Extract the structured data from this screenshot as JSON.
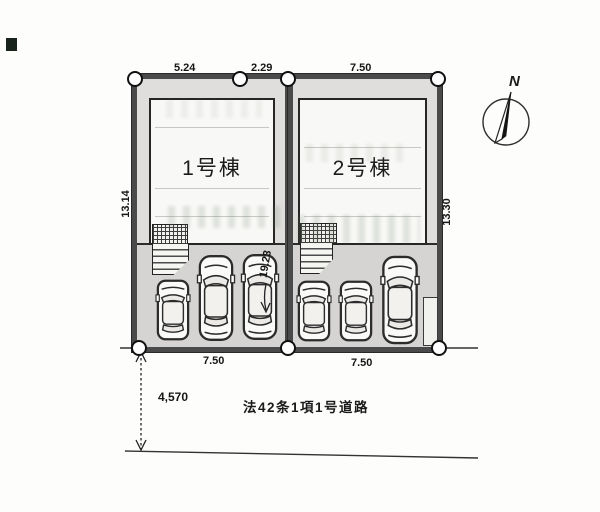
{
  "diagram_title": "site-plan",
  "north_label": "N",
  "lots": {
    "lot1": {
      "building_label": "1号棟",
      "top_dim_a": "5.24",
      "top_dim_b": "2.29",
      "side_dim": "13.14",
      "bottom_dim": "7.50"
    },
    "lot2": {
      "building_label": "2号棟",
      "top_dim": "7.50",
      "side_dim": "13.30",
      "bottom_dim": "7.50"
    },
    "center_dim": "19.23"
  },
  "road": {
    "label": "法42条1項1号道路",
    "width_dim": "4,570"
  },
  "colors": {
    "paper": "#fdfdfc",
    "ink": "#1e1e1e",
    "lot_border": "#4a4a4a",
    "yard": "#dfdedc",
    "parking": "#d5d4d2"
  }
}
